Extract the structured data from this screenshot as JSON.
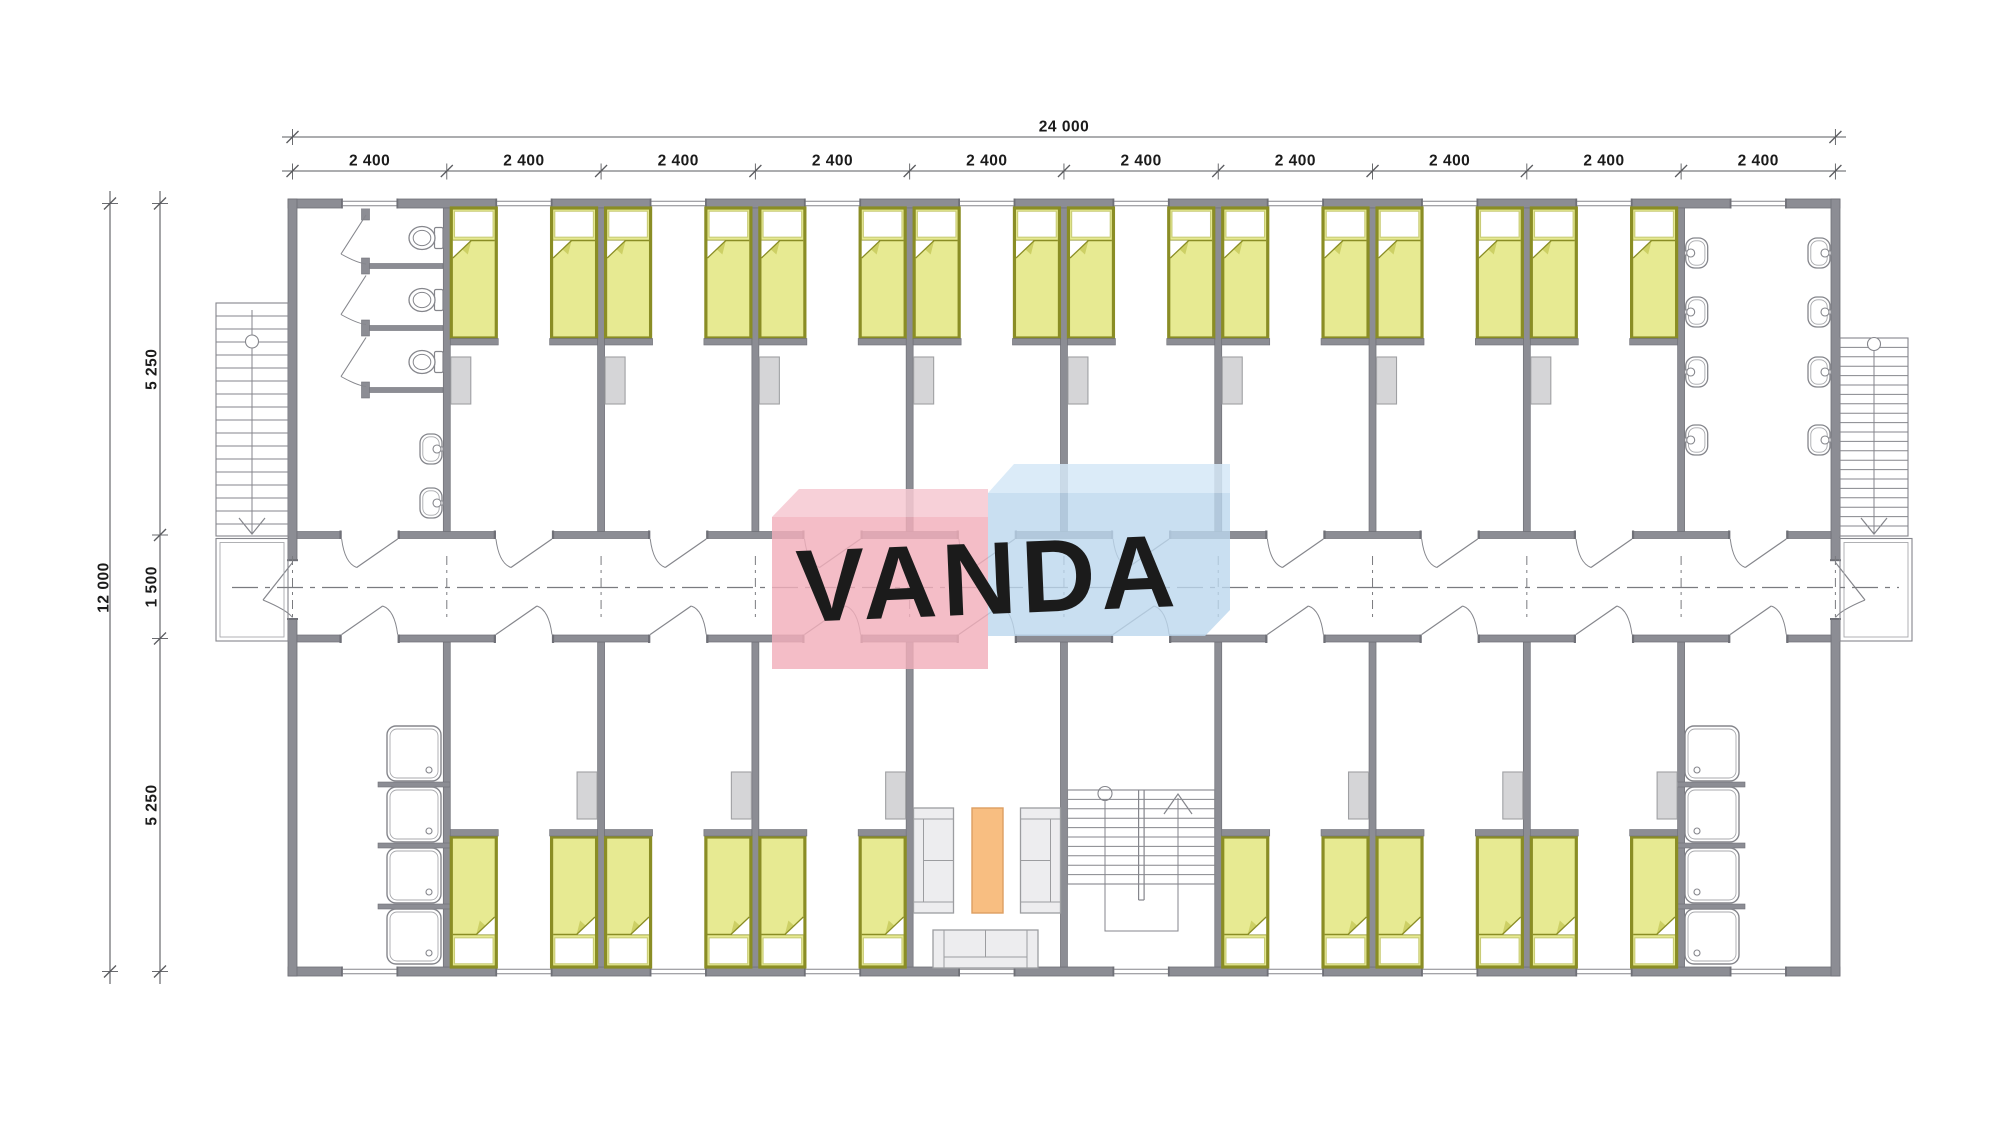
{
  "watermark": {
    "text": "VANDA"
  },
  "dimensions": {
    "top_total": "24 000",
    "top_segments": [
      "2 400",
      "2 400",
      "2 400",
      "2 400",
      "2 400",
      "2 400",
      "2 400",
      "2 400",
      "2 400",
      "2 400"
    ],
    "left_total": "12 000",
    "left_segments": [
      "5 250",
      "1 500",
      "5 250"
    ]
  },
  "plan": {
    "building_mm": {
      "width": 24000,
      "depth": 12000,
      "bay_width": 2400,
      "top_room_depth": 5250,
      "corridor_width": 1500,
      "bottom_room_depth": 5250
    },
    "sections_top": [
      "toilets",
      "bedroom",
      "bedroom",
      "bedroom",
      "bedroom",
      "bedroom",
      "bedroom",
      "bedroom",
      "bedroom",
      "washroom"
    ],
    "sections_bottom": [
      "showers",
      "bedroom",
      "bedroom",
      "bedroom",
      "lounge",
      "stairwell",
      "bedroom",
      "bedroom",
      "bedroom",
      "showers"
    ],
    "fixtures": {
      "beds_top": 16,
      "beds_bottom": 12,
      "toilet_stalls": 3,
      "bathroom_sinks": 2,
      "washroom_sinks": 8,
      "shower_trays_left": 4,
      "shower_trays_right": 4,
      "lockers": 14,
      "sofas": 3,
      "coffee_table": 1,
      "external_stairs": 2,
      "internal_stairs": 1
    }
  },
  "colors": {
    "wall": "#8C8D94",
    "wall_edge": "#6F7077",
    "line": "#85868C",
    "line_light": "#A8A9AD",
    "bed_frame": "#8A8D25",
    "bed_blanket": "#E7EA92",
    "bed_fold": "#CDD065",
    "pillow_edge": "#C9CC77",
    "locker": "#D5D5D7",
    "locker_edge": "#9FA0A3",
    "sofa": "#EDEDEF",
    "sofa_edge": "#9C9DA0",
    "table": "#F8BE81",
    "table_edge": "#DD9E62",
    "centerline": "#7A7B7F",
    "dim_line": "#5A5B5F",
    "dim_text": "#1B1B1B",
    "logo_pink": "rgba(242,174,187,0.82)",
    "logo_pink_top": "rgba(246,200,210,0.86)",
    "logo_blue": "rgba(187,215,238,0.80)",
    "logo_blue_top": "rgba(213,231,247,0.85)",
    "logo_text": "rgba(255,255,255,0.95)"
  }
}
